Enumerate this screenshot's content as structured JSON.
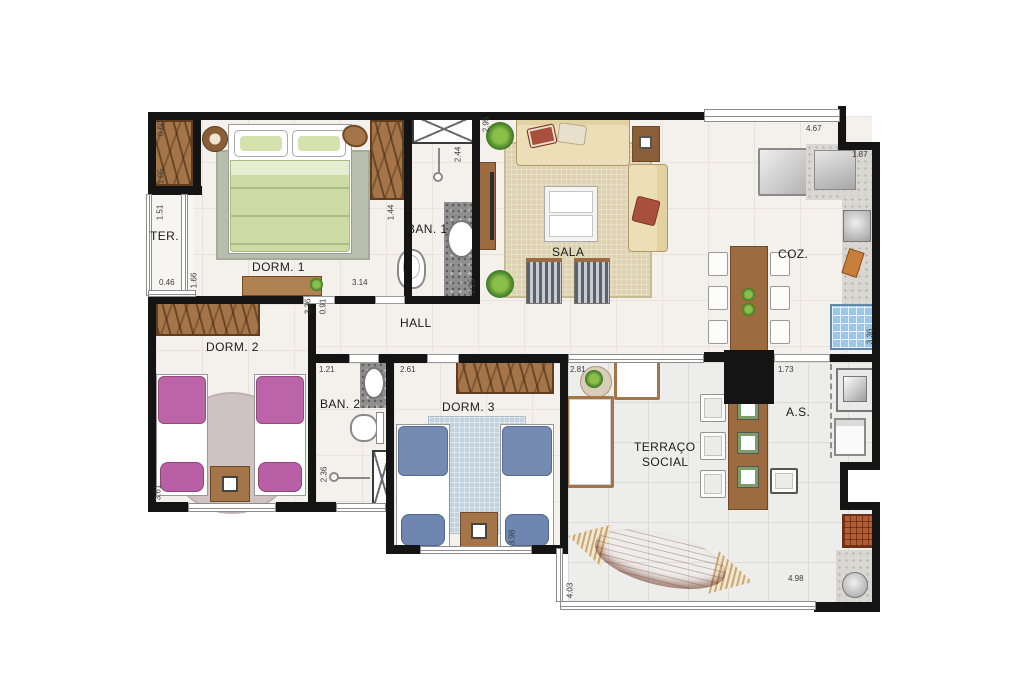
{
  "rooms": {
    "ter": {
      "label": "TER."
    },
    "dorm1": {
      "label": "DORM. 1"
    },
    "ban1": {
      "label": "BAN. 1"
    },
    "sala": {
      "label": "SALA"
    },
    "coz": {
      "label": "COZ."
    },
    "hall": {
      "label": "HALL"
    },
    "dorm2": {
      "label": "DORM. 2"
    },
    "ban2": {
      "label": "BAN. 2"
    },
    "dorm3": {
      "label": "DORM. 3"
    },
    "terraco": {
      "line1": "TERRAÇO",
      "line2": "SOCIAL"
    },
    "as": {
      "label": "A.S."
    }
  },
  "dimensions": [
    {
      "text": "1.51"
    },
    {
      "text": "0.46"
    },
    {
      "text": "1.66"
    },
    {
      "text": "3.14"
    },
    {
      "text": "3.36"
    },
    {
      "text": "0.91"
    },
    {
      "text": "2.44"
    },
    {
      "text": "1.44"
    },
    {
      "text": "1.25"
    },
    {
      "text": "2.95"
    },
    {
      "text": "4.67"
    },
    {
      "text": "1.87"
    },
    {
      "text": "3.36"
    },
    {
      "text": "1.21"
    },
    {
      "text": "2.61"
    },
    {
      "text": "2.81"
    },
    {
      "text": "1.73"
    },
    {
      "text": "2.36"
    },
    {
      "text": "3.61"
    },
    {
      "text": "3.98"
    },
    {
      "text": "4.03"
    },
    {
      "text": "4.98"
    },
    {
      "text": "0.60"
    },
    {
      "text": "1.05"
    }
  ],
  "palette": {
    "wall": "#141414",
    "wood": "#a5754a",
    "floor": "#f4f1ec",
    "terrace_tile": "#ededec",
    "bed_green": "#ccdca4",
    "bed_pink": "#bb64a8",
    "bed_blue": "#748ab0",
    "sofa_beige": "#ecdfb7",
    "hammock_orange": "#cf5f2e",
    "sink_blue": "#9cc8e8",
    "granite_dark": "#8f8f8f"
  }
}
